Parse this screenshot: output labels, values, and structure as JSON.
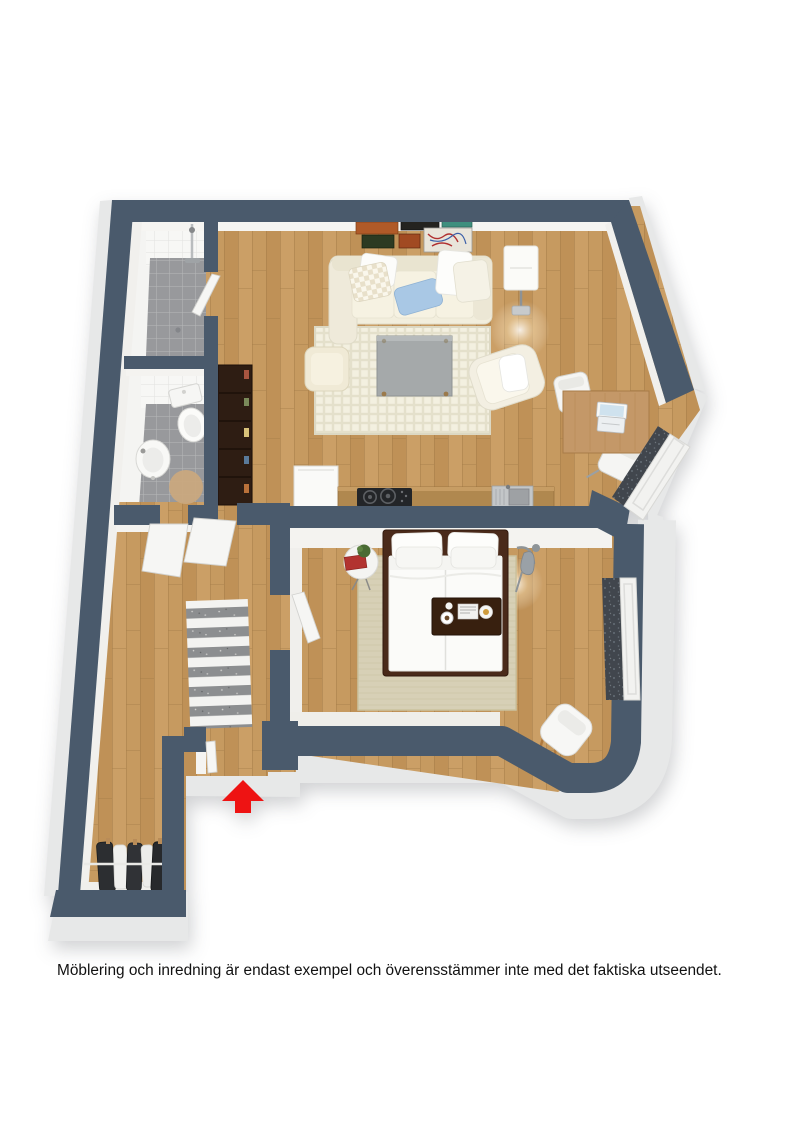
{
  "caption": {
    "text": "Möblering och inredning är endast exempel och överensstämmer inte med det faktiska utseendet."
  },
  "entrance": {
    "arrow_icon": "arrow-up-icon",
    "arrow_color": "#ee1313"
  },
  "palette": {
    "background": "#ffffff",
    "wall": "#4a5a6c",
    "wall_face": "#f3f2ef",
    "bevel": "#e7e8e8",
    "wood_floor": "#c69a60",
    "wood_joint": "#a37b47",
    "tile_floor": "#98999c",
    "counter": "#b0884f",
    "cooktop": "#232528",
    "sink_steel": "#c3c6c8",
    "bookshelf": "#2e1d13",
    "bed_frame": "#4a2a1a",
    "bedding": "#fbfbf9",
    "sofa": "#f2eedd",
    "pillow_blue": "#a9c8e5",
    "coffee_table": "#a5a9aa",
    "desk_wood": "#c49868",
    "rug_living": "#e9e5d2",
    "rug_bedroom": "#d7d0b6",
    "rug_hall_gray": "#8c8e90",
    "window_glass": "#41464d",
    "radiator": "#f2f2f0",
    "caption_color": "#111111"
  },
  "regions": {
    "names": [
      "living-room",
      "kitchenette",
      "bedroom",
      "shower-room",
      "wc",
      "hallway",
      "entrance",
      "closet-corridor"
    ]
  },
  "furniture_icons": [
    "sofa",
    "pillow",
    "wall-art",
    "floor-lamp",
    "area-rug",
    "coffee-table",
    "pouf",
    "armchair",
    "dining-table",
    "chair",
    "laptop",
    "fridge",
    "cooktop",
    "kitchen-sink",
    "bookshelf",
    "double-bed",
    "pillows",
    "bed-tray",
    "bedside-table",
    "plant",
    "arc-lamp",
    "bedroom-rug",
    "bedroom-chair",
    "shower",
    "shower-screen",
    "toilet",
    "wash-basin",
    "round-mat",
    "striped-rug",
    "door-leaf",
    "wardrobe-clothes",
    "clothes-rail",
    "window",
    "radiator",
    "arrow-up-icon"
  ]
}
